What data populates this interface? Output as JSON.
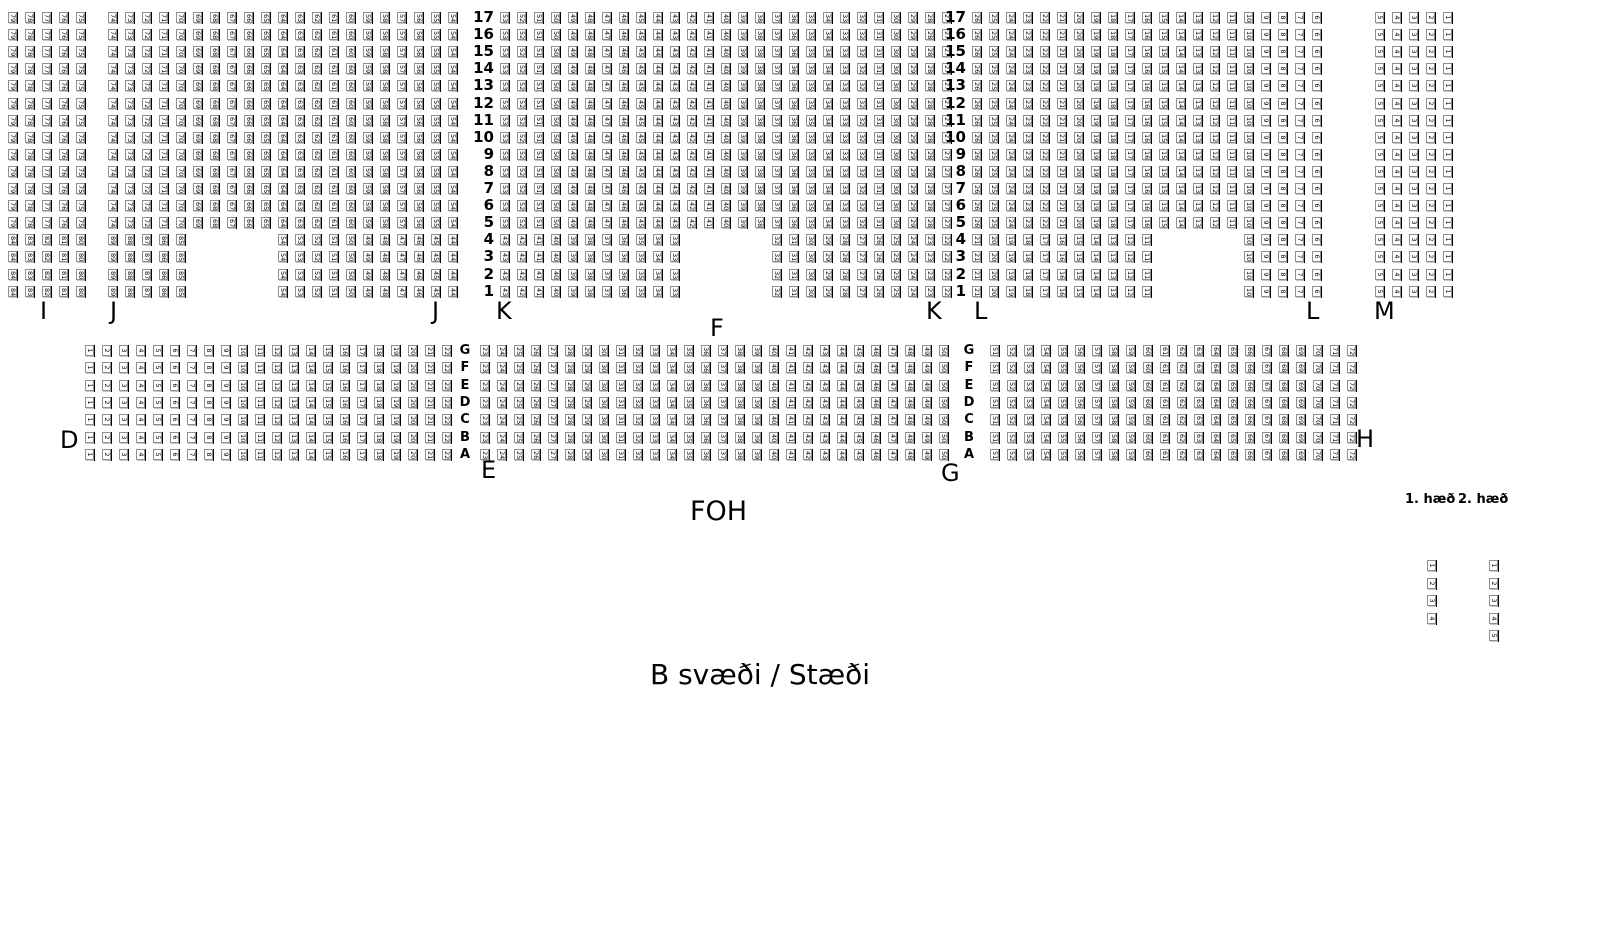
{
  "map_title": "B svæði / Stæði",
  "foh_label": "FOH",
  "sections": {
    "upper_labels": [
      "I",
      "J",
      "J",
      "K",
      "K",
      "L",
      "L",
      "M"
    ],
    "middle_label": "F",
    "lower_labels": [
      "D",
      "E",
      "G",
      "H"
    ]
  },
  "upper_block": {
    "row_numbers": [
      17,
      16,
      15,
      14,
      13,
      12,
      11,
      10,
      9,
      8,
      7,
      6,
      5,
      4,
      3,
      2,
      1
    ],
    "full_rows": {
      "rows": "5-17",
      "groups": [
        {
          "section": "I",
          "first_seat": 79,
          "last_seat": 75
        },
        {
          "section": "J",
          "first_seat": 74,
          "last_seat": 54
        },
        {
          "section": "K",
          "first_seat": 53,
          "last_seat": 27
        },
        {
          "section": "L",
          "first_seat": 26,
          "last_seat": 6
        },
        {
          "section": "M",
          "first_seat": 5,
          "last_seat": 1
        }
      ]
    },
    "short_rows": {
      "rows": "1-4",
      "groups": [
        {
          "section": "I",
          "first_seat": 84,
          "last_seat": 80
        },
        {
          "section": "J",
          "first_seat": 89,
          "last_seat": 85
        },
        {
          "section": "J",
          "first_seat": 54,
          "last_seat": 44
        },
        {
          "section": "K",
          "first_seat": 43,
          "last_seat": 33
        },
        {
          "section": "K",
          "first_seat": 32,
          "last_seat": 22
        },
        {
          "section": "L",
          "first_seat": 21,
          "last_seat": 11
        },
        {
          "section": "L",
          "first_seat": 10,
          "last_seat": 6
        },
        {
          "section": "M",
          "first_seat": 5,
          "last_seat": 1
        }
      ]
    }
  },
  "lower_block": {
    "row_letters": [
      "G",
      "F",
      "E",
      "D",
      "C",
      "B",
      "A"
    ],
    "groups": [
      {
        "block": "left",
        "first_seat": 1,
        "last_seat": 22
      },
      {
        "block": "middle",
        "first_seat": 23,
        "last_seat": 50
      },
      {
        "block": "right",
        "first_seat": 51,
        "last_seat": 72
      }
    ]
  },
  "balcony": {
    "columns": [
      {
        "label": "1. hæð",
        "seats": [
          1,
          2,
          3,
          4
        ]
      },
      {
        "label": "2. hæð",
        "seats": [
          1,
          2,
          3,
          4,
          5
        ]
      }
    ]
  }
}
